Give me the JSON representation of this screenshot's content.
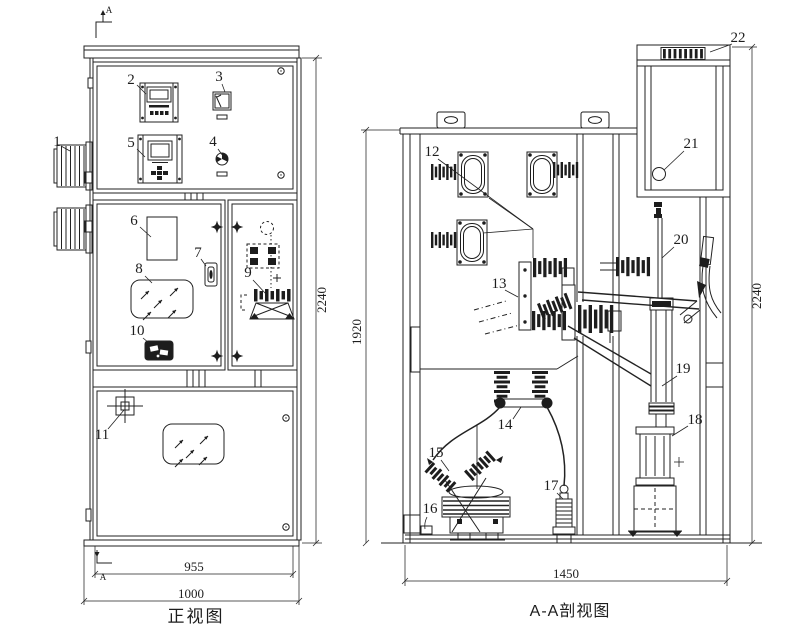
{
  "colors": {
    "background": "#ffffff",
    "ink": "#1d1d1d"
  },
  "front_view": {
    "title": "正视图",
    "section_mark_top": "A",
    "section_mark_bottom": "A",
    "dim_height": "2240",
    "dim_width_inner": "955",
    "dim_width_outer": "1000",
    "callouts": {
      "c1": "1",
      "c2": "2",
      "c3": "3",
      "c4": "4",
      "c5": "5",
      "c6": "6",
      "c7": "7",
      "c8": "8",
      "c9": "9",
      "c10": "10",
      "c11": "11"
    }
  },
  "section_view": {
    "title": "A-A剖视图",
    "dim_height_inner": "1920",
    "dim_height_outer": "2240",
    "dim_width": "1450",
    "callouts": {
      "c12": "12",
      "c13": "13",
      "c14": "14",
      "c15": "15",
      "c16": "16",
      "c17": "17",
      "c18": "18",
      "c19": "19",
      "c20": "20",
      "c21": "21",
      "c22": "22"
    }
  }
}
